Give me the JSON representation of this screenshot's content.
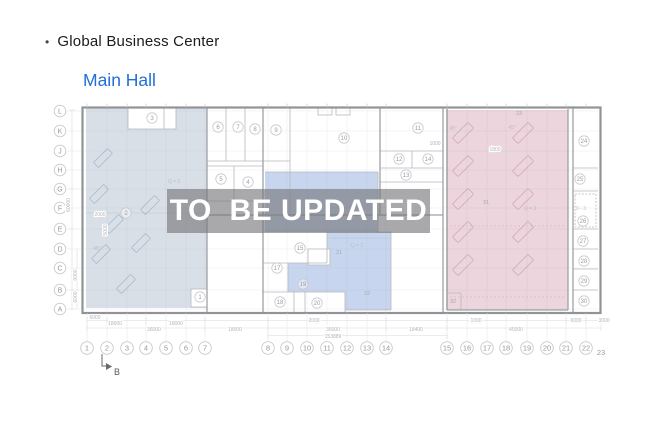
{
  "header": {
    "bullet": "•",
    "title": "Global Business Center",
    "subtitle": "Main Hall"
  },
  "watermark": {
    "text": "TO  BE UPDATED"
  },
  "colors": {
    "subtitle_blue": "#1f6fd8",
    "region_left": "#d9dfe7",
    "region_middle": "#c6d6ee",
    "region_right": "#ecd5dc",
    "watermark_band": "#78787d",
    "watermark_text": "#ffffff"
  },
  "plan": {
    "section_marker": "B",
    "rows": [
      {
        "label": "L",
        "y": 111
      },
      {
        "label": "K",
        "y": 131
      },
      {
        "label": "J",
        "y": 151
      },
      {
        "label": "H",
        "y": 170
      },
      {
        "label": "G",
        "y": 189
      },
      {
        "label": "F",
        "y": 208
      },
      {
        "label": "E",
        "y": 229
      },
      {
        "label": "D",
        "y": 249
      },
      {
        "label": "C",
        "y": 268
      },
      {
        "label": "B",
        "y": 290
      },
      {
        "label": "A",
        "y": 309
      }
    ],
    "cols": [
      {
        "label": "1",
        "x": 87
      },
      {
        "label": "2",
        "x": 107
      },
      {
        "label": "3",
        "x": 127
      },
      {
        "label": "4",
        "x": 146
      },
      {
        "label": "5",
        "x": 166
      },
      {
        "label": "6",
        "x": 186
      },
      {
        "label": "7",
        "x": 205
      },
      {
        "label": "8",
        "x": 268
      },
      {
        "label": "9",
        "x": 287
      },
      {
        "label": "10",
        "x": 307
      },
      {
        "label": "11",
        "x": 327
      },
      {
        "label": "12",
        "x": 347
      },
      {
        "label": "13",
        "x": 367
      },
      {
        "label": "14",
        "x": 386
      },
      {
        "label": "15",
        "x": 447
      },
      {
        "label": "16",
        "x": 467
      },
      {
        "label": "17",
        "x": 487
      },
      {
        "label": "18",
        "x": 506
      },
      {
        "label": "19",
        "x": 527
      },
      {
        "label": "20",
        "x": 547
      },
      {
        "label": "21",
        "x": 566
      },
      {
        "label": "22",
        "x": 586
      },
      {
        "label": "23",
        "x": 601,
        "y": 355,
        "circled": false
      }
    ],
    "rooms": [
      {
        "n": "1",
        "x": 200,
        "y": 297
      },
      {
        "n": "2",
        "x": 126,
        "y": 213
      },
      {
        "n": "3",
        "x": 152,
        "y": 118
      },
      {
        "n": "4",
        "x": 248,
        "y": 182
      },
      {
        "n": "5",
        "x": 221,
        "y": 179
      },
      {
        "n": "6",
        "x": 218,
        "y": 127
      },
      {
        "n": "7",
        "x": 238,
        "y": 127
      },
      {
        "n": "8",
        "x": 255,
        "y": 129
      },
      {
        "n": "9",
        "x": 276,
        "y": 130
      },
      {
        "n": "10",
        "x": 344,
        "y": 138
      },
      {
        "n": "11",
        "x": 418,
        "y": 128
      },
      {
        "n": "12",
        "x": 399,
        "y": 159
      },
      {
        "n": "13",
        "x": 406,
        "y": 175
      },
      {
        "n": "14",
        "x": 428,
        "y": 159
      },
      {
        "n": "15",
        "x": 300,
        "y": 248
      },
      {
        "n": "17",
        "x": 277,
        "y": 268
      },
      {
        "n": "18",
        "x": 280,
        "y": 302
      },
      {
        "n": "19",
        "x": 303,
        "y": 284
      },
      {
        "n": "20",
        "x": 317,
        "y": 303
      },
      {
        "n": "21",
        "x": 339,
        "y": 252,
        "c": false
      },
      {
        "n": "22",
        "x": 367,
        "y": 293,
        "c": false
      },
      {
        "n": "23",
        "x": 519,
        "y": 113,
        "c": false
      },
      {
        "n": "24",
        "x": 584,
        "y": 141
      },
      {
        "n": "25",
        "x": 580,
        "y": 179
      },
      {
        "n": "26",
        "x": 583,
        "y": 221
      },
      {
        "n": "27",
        "x": 583,
        "y": 241
      },
      {
        "n": "28",
        "x": 584,
        "y": 261
      },
      {
        "n": "29",
        "x": 584,
        "y": 281
      },
      {
        "n": "30",
        "x": 584,
        "y": 301
      },
      {
        "n": "31",
        "x": 486,
        "y": 202,
        "c": false
      },
      {
        "n": "32",
        "x": 453,
        "y": 301,
        "c": false
      }
    ],
    "zones": [
      {
        "t": "Q = 3",
        "x": 174,
        "y": 183
      },
      {
        "t": "Q = 3",
        "x": 357,
        "y": 247
      },
      {
        "t": "Q = 3",
        "x": 530,
        "y": 210
      },
      {
        "t": "0 - 3",
        "x": 581,
        "y": 210
      },
      {
        "t": "45°",
        "x": 453,
        "y": 130
      },
      {
        "t": "45°",
        "x": 512,
        "y": 129
      },
      {
        "t": "45°",
        "x": 97,
        "y": 250
      }
    ],
    "dims_h": [
      {
        "t": "6000",
        "x": 95,
        "y": 319
      },
      {
        "t": "18000",
        "x": 115,
        "y": 325
      },
      {
        "t": "18000",
        "x": 176,
        "y": 325
      },
      {
        "t": "2000",
        "x": 314,
        "y": 322
      },
      {
        "t": "1000",
        "x": 476,
        "y": 322
      },
      {
        "t": "6000",
        "x": 576,
        "y": 322
      },
      {
        "t": "3000",
        "x": 604,
        "y": 322
      },
      {
        "t": "36000",
        "x": 154,
        "y": 331
      },
      {
        "t": "18000",
        "x": 235,
        "y": 331
      },
      {
        "t": "36000",
        "x": 333,
        "y": 331
      },
      {
        "t": "18400",
        "x": 416,
        "y": 331
      },
      {
        "t": "45000",
        "x": 516,
        "y": 331
      },
      {
        "t": "153889",
        "x": 333,
        "y": 338
      },
      {
        "t": "2000",
        "x": 100,
        "y": 216
      },
      {
        "t": "1000",
        "x": 435,
        "y": 145
      },
      {
        "t": "1800",
        "x": 495,
        "y": 151
      }
    ],
    "dims_v": [
      {
        "t": "60000",
        "x": 70,
        "y": 205
      },
      {
        "t": "6000",
        "x": 77,
        "y": 275
      },
      {
        "t": "6000",
        "x": 77,
        "y": 297
      },
      {
        "t": "5000",
        "x": 107,
        "y": 230
      }
    ],
    "racks_left": [
      {
        "x": 103,
        "y": 158
      },
      {
        "x": 99,
        "y": 194
      },
      {
        "x": 114,
        "y": 224
      },
      {
        "x": 101,
        "y": 254
      },
      {
        "x": 141,
        "y": 243
      },
      {
        "x": 150,
        "y": 205
      },
      {
        "x": 126,
        "y": 284
      }
    ],
    "racks_pink": [
      {
        "x": 463,
        "y": 133
      },
      {
        "x": 463,
        "y": 166
      },
      {
        "x": 463,
        "y": 199
      },
      {
        "x": 463,
        "y": 232
      },
      {
        "x": 463,
        "y": 265
      },
      {
        "x": 523,
        "y": 133
      },
      {
        "x": 523,
        "y": 166
      },
      {
        "x": 523,
        "y": 199
      },
      {
        "x": 523,
        "y": 232
      },
      {
        "x": 523,
        "y": 265
      }
    ]
  }
}
